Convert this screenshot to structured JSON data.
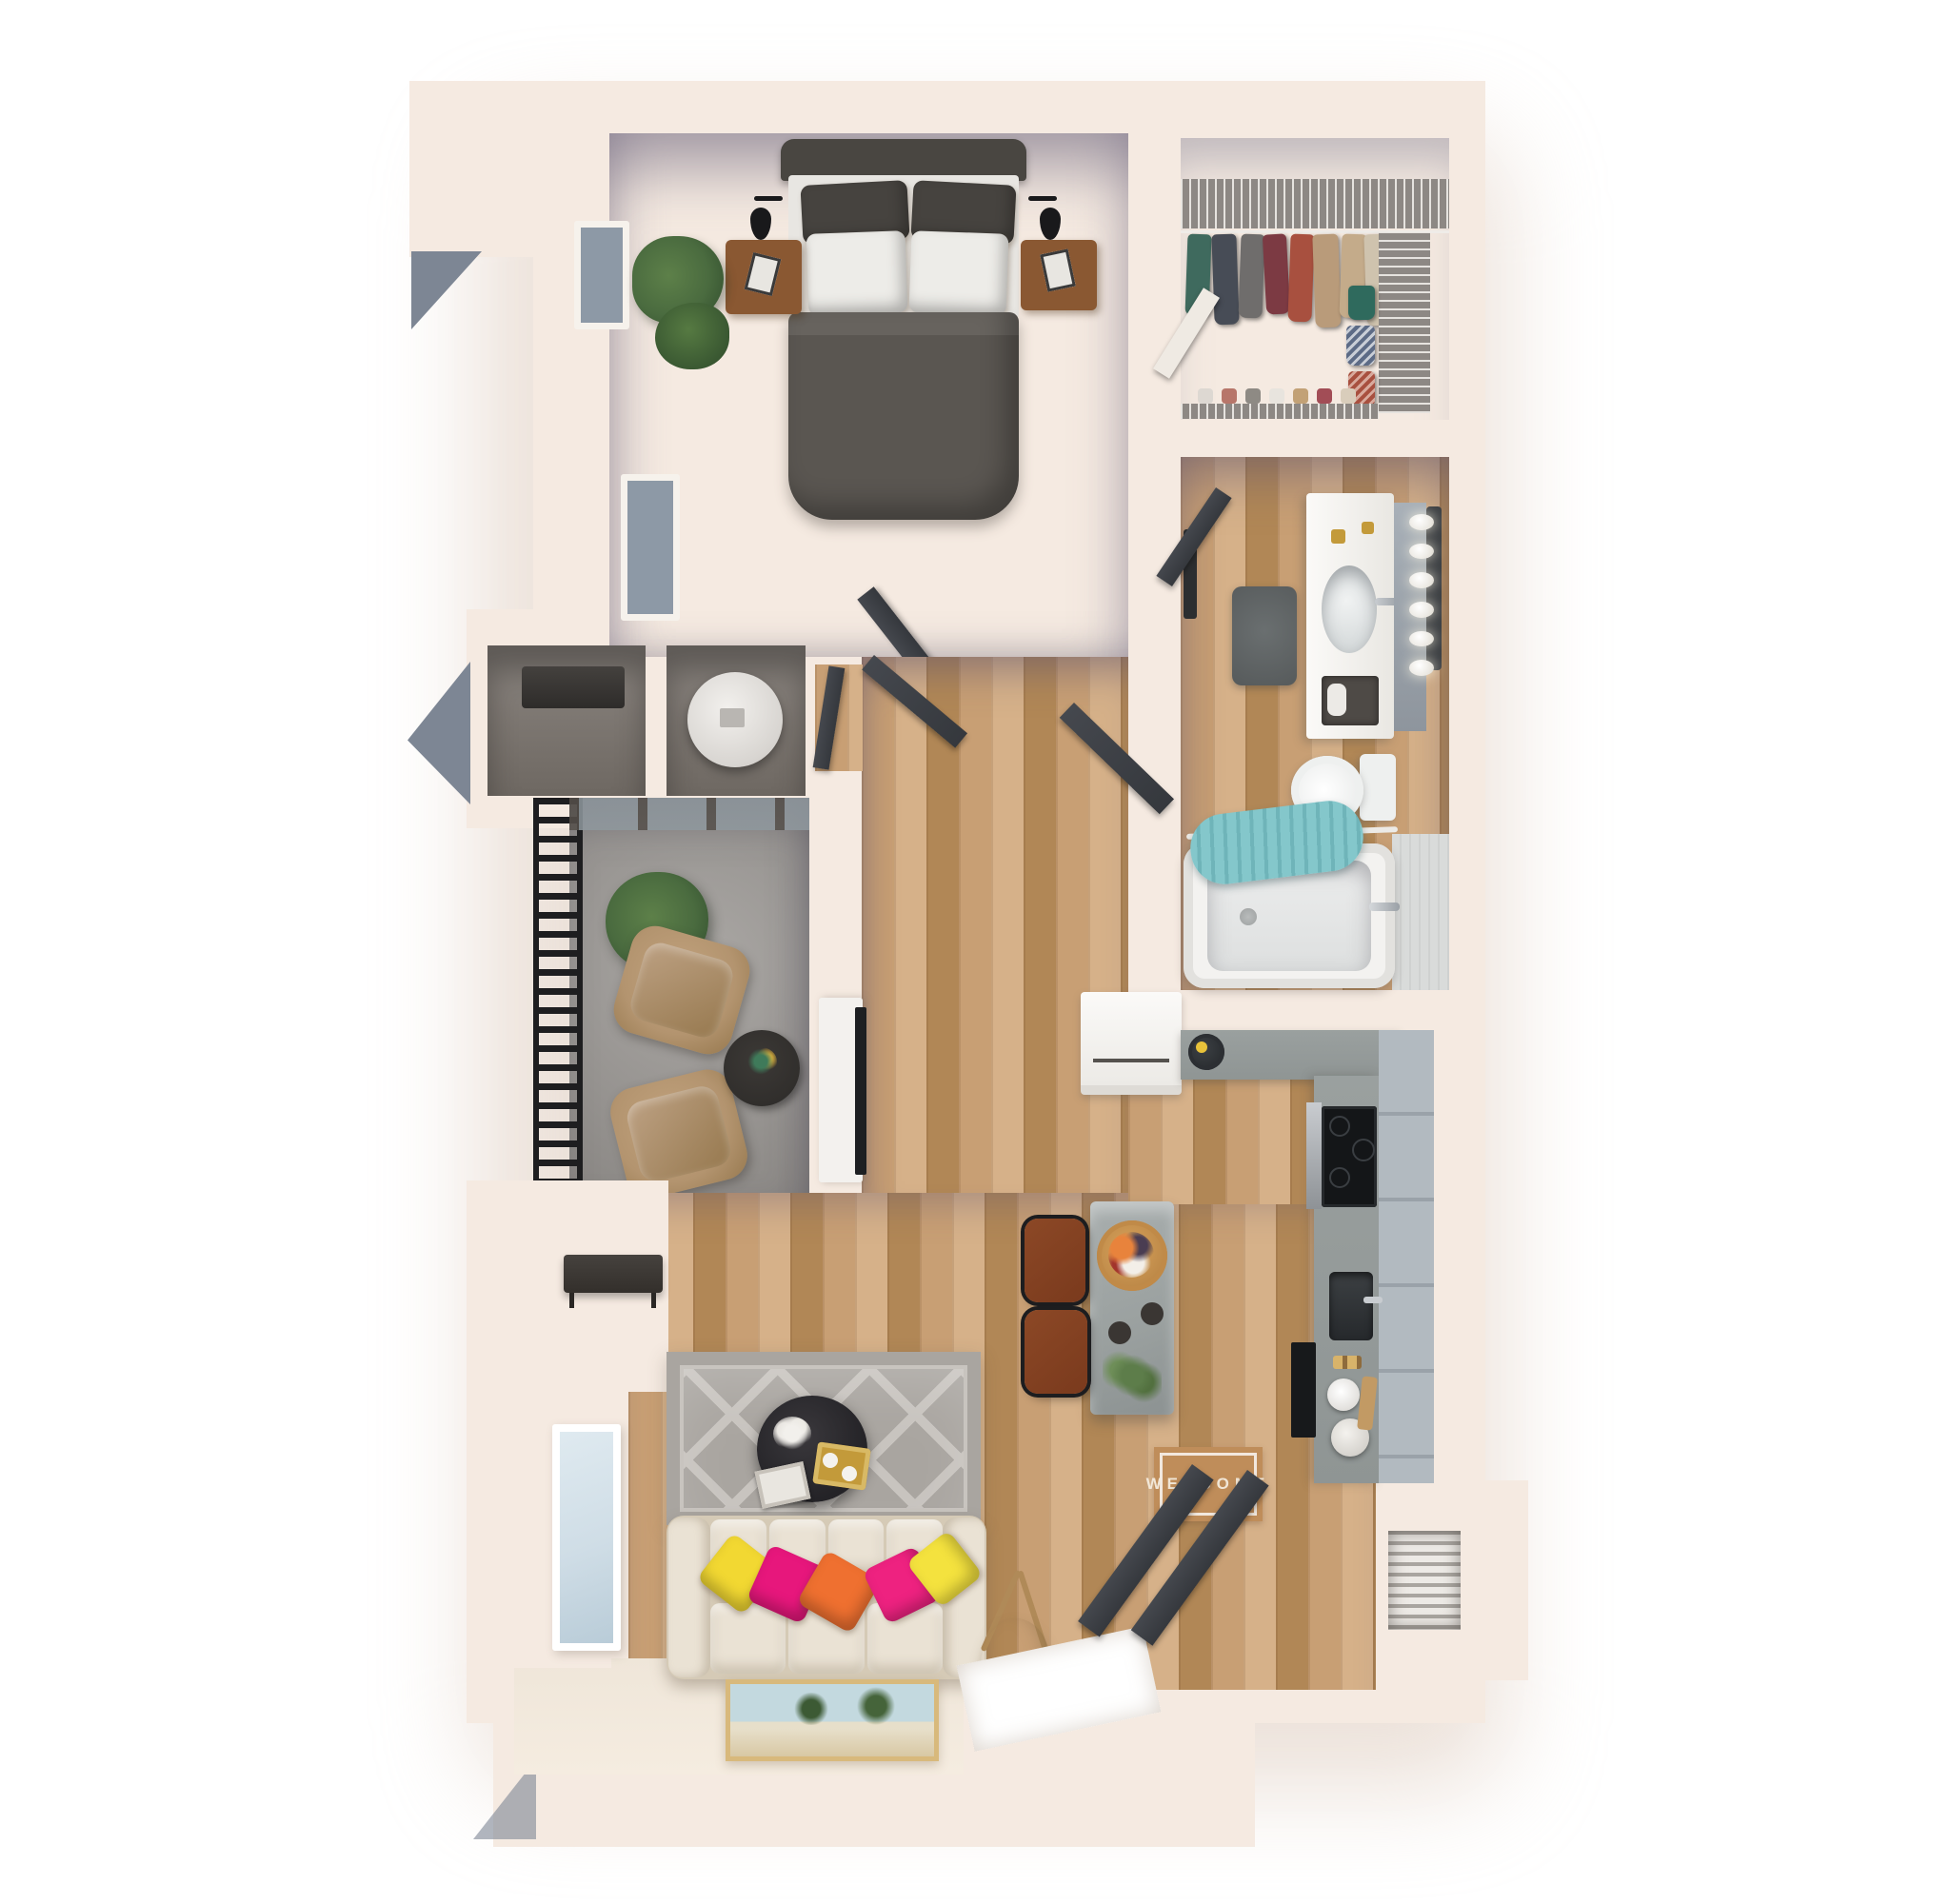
{
  "scene": {
    "type": "3d-floor-plan-top-down-render",
    "mat": {
      "text": "WELCOME"
    },
    "rooms": [
      "bedroom",
      "walk-in-closet",
      "bathroom",
      "laundry-closet",
      "hallway",
      "balcony",
      "living-room",
      "kitchen",
      "entry",
      "utility-closets",
      "coat-closet"
    ],
    "vanity_light_count": 6
  },
  "palette": {
    "page": "#ffffff",
    "wall": "#f5eae1",
    "wall_bright": "#faf2ea",
    "wall_shade": "#e6d6c9",
    "wood": "#c89f74",
    "wood_light": "#d6b189",
    "wood_dark": "#b18756",
    "carpet": "#877d72",
    "railing": "#1e1e20",
    "counter": "#8f9594",
    "cabinet": "#b2bac0",
    "island": "#9aa09f",
    "appliance_white": "#f3f1ee",
    "door_dark": "#35383d",
    "sofa": "#eae2d4",
    "sofa_shadow": "#d5cab6",
    "rug": "#a9a5a0",
    "rug_line": "#c8c4bf",
    "bed": "#5a5651",
    "headboard": "#494641",
    "pillow_dark": "#46433f",
    "pillow_white": "#edece8",
    "nightstand": "#8a5832",
    "plant": "#4a6b3f",
    "plant_dark": "#2e4a2b",
    "chair": "#b3946f",
    "chair_dark": "#97794f",
    "table_dark": "#2c2a28",
    "towel_teal": "#84c7cb",
    "tub": "#f3f2f0",
    "mat_bg": "#bf8d5a",
    "mat_text": "#f6eee1",
    "stool": "#7a3a1d",
    "lamp_shade": "#d9c7a8",
    "glass": "#cfdde6",
    "window_glass": "#8d99a6",
    "art_sky": "#c3d9df",
    "art_sand": "#d8c8a4",
    "gold": "#c39a3a",
    "pillow_yellow": "#f2d832",
    "pillow_magenta": "#e7177c",
    "pillow_orange": "#ef7030",
    "pillow_pink": "#ee2280",
    "pillow_yellow2": "#f4e23e",
    "vacuum_accent": "#e8c23a"
  }
}
